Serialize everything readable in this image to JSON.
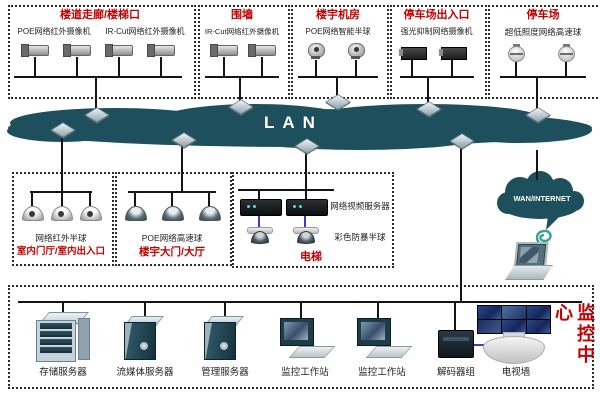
{
  "lan": {
    "label": "LAN"
  },
  "wan": {
    "label": "WAN/INTERNET"
  },
  "top_groups": [
    {
      "title": "楼道走廊/楼梯口",
      "labels": [
        "POE网络红外摄像机",
        "IR-Cut网络红外摄像机"
      ]
    },
    {
      "title": "围墙",
      "labels": [
        "IR-Cut网络红外摄像机"
      ]
    },
    {
      "title": "楼宇机房",
      "labels": [
        "POE网络智能半球"
      ]
    },
    {
      "title": "停车场出入口",
      "labels": [
        "强光抑制网络摄像机"
      ]
    },
    {
      "title": "停车场",
      "labels": [
        "超低照度网络高速球"
      ]
    }
  ],
  "mid_groups": [
    {
      "title": "室内门厅/室内出入口",
      "labels": [
        "网络红外半球"
      ]
    },
    {
      "title": "楼宇大门/大厅",
      "labels": [
        "POE网络高速球"
      ]
    },
    {
      "title": "电梯",
      "labels": [
        "网络视频服务器",
        "彩色防暴半球"
      ]
    }
  ],
  "monitor_center": {
    "title": "监控中心",
    "devices": [
      "存储服务器",
      "流媒体服务器",
      "管理服务器",
      "监控工作站",
      "监控工作站",
      "解码器组",
      "电视墙"
    ]
  },
  "colors": {
    "cloud": "#1d4f5d",
    "accent_red": "#c40000",
    "line": "#151515",
    "blue_link": "#3b3bd0"
  }
}
